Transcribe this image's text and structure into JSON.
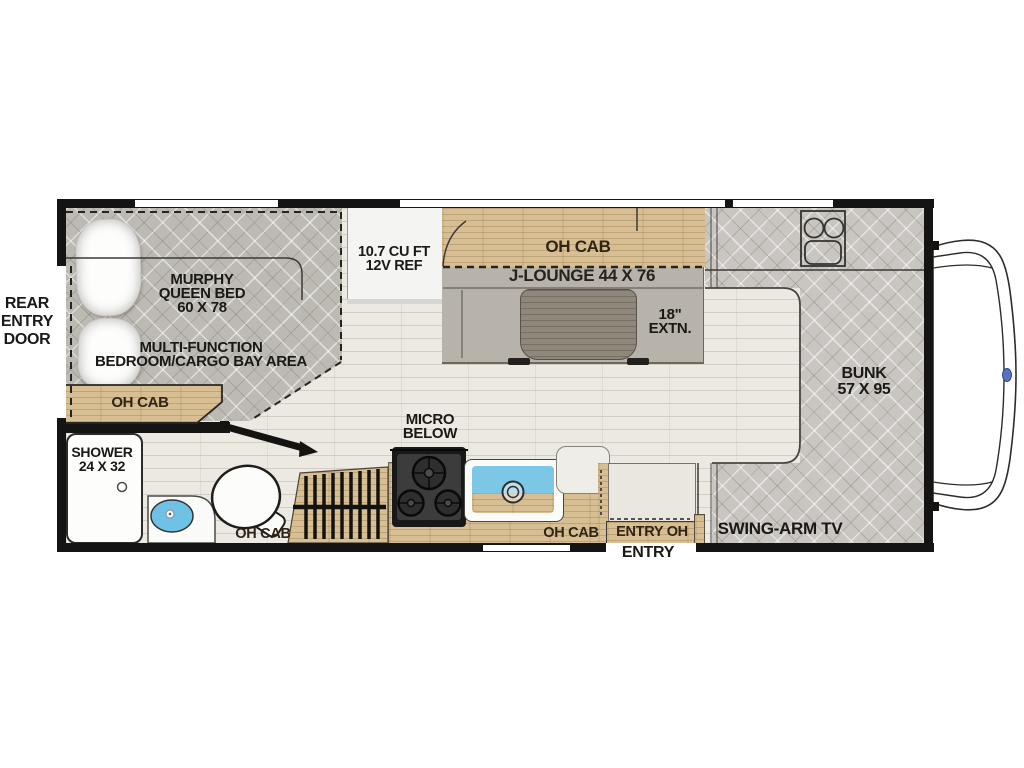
{
  "labels": {
    "rear_entry_door": "REAR\nENTRY\nDOOR",
    "murphy_bed": "MURPHY\nQUEEN BED\n60 X 78",
    "multi_function": "MULTI-FUNCTION\nBEDROOM/CARGO BAY AREA",
    "oh_cab_bedroom": "OH CAB",
    "fridge": "10.7 CU FT\n12V REF",
    "oh_cab_dinette": "OH CAB",
    "j_lounge": "J-LOUNGE 44 X 76",
    "extension": "18\"\nEXTN.",
    "bunk": "BUNK\n57 X 95",
    "micro_below": "MICRO\nBELOW",
    "shower": "SHOWER\n24 X 32",
    "oh_cab_bath": "OH CAB",
    "oh_cab_kitchen": "OH CAB",
    "entry_oh": "ENTRY OH",
    "entry": "ENTRY",
    "swing_arm_tv": "SWING-ARM TV"
  },
  "colors": {
    "wall": "#161412",
    "wood_cabinet": "#d7bf93",
    "mattress_gray": "#c9c6c1",
    "lounge_gray": "#b7b2aa",
    "sink_blue": "#7cc6e6",
    "bath_sink_blue": "#6fc2e6",
    "logo_blue": "#5873bb",
    "floor": "#ece9e2"
  }
}
